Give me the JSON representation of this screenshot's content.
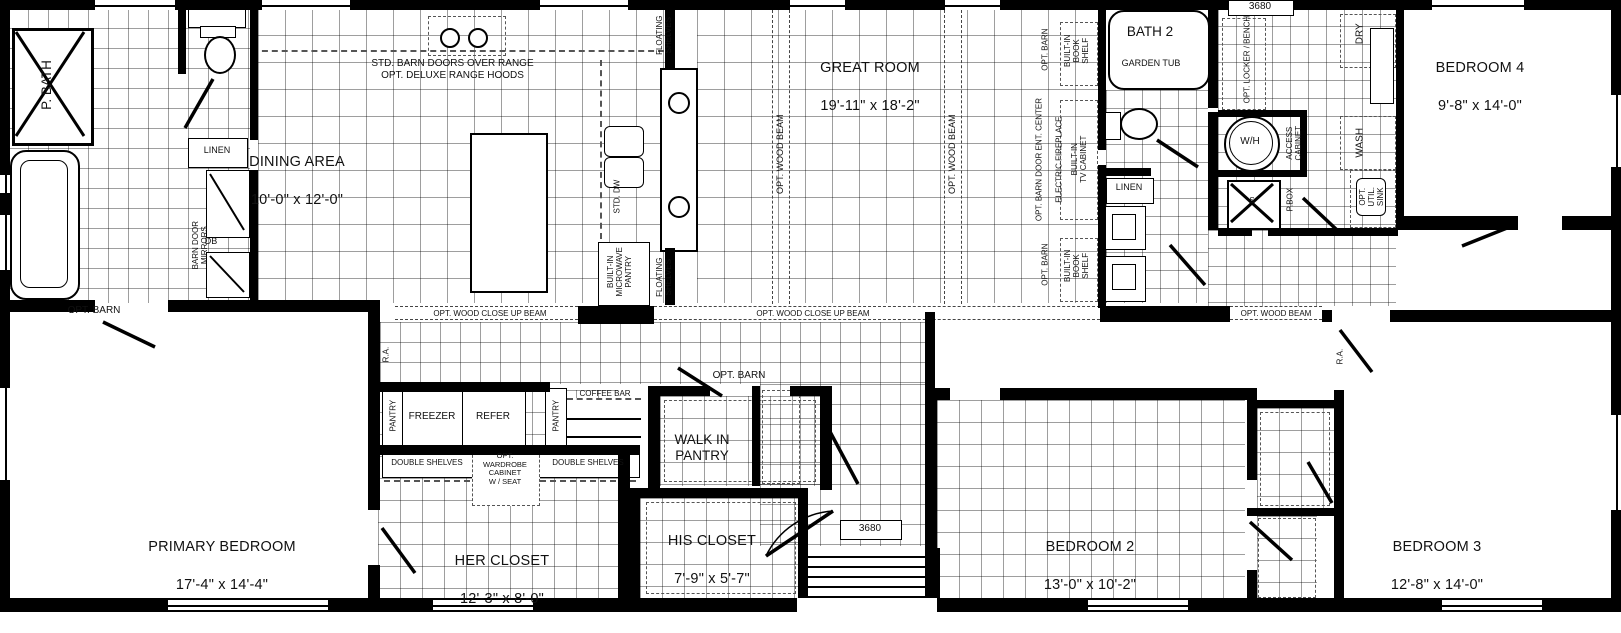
{
  "rooms": {
    "p_bath": {
      "name": "P. BATH"
    },
    "dining": {
      "name": "DINING AREA",
      "dims": "10'-0\" x 12'-0\""
    },
    "great_room": {
      "name": "GREAT ROOM",
      "dims": "19'-11\" x 18'-2\""
    },
    "bath2": {
      "name": "BATH 2",
      "sub": "GARDEN TUB"
    },
    "bedroom4": {
      "name": "BEDROOM 4",
      "dims": "9'-8\" x 14'-0\""
    },
    "primary": {
      "name": "PRIMARY BEDROOM",
      "dims": "17'-4\" x 14'-4\""
    },
    "her_closet": {
      "name": "HER CLOSET",
      "dims": "12'-3\" x 8'-0\""
    },
    "his_closet": {
      "name": "HIS CLOSET",
      "dims": "7'-9\" x 5'-7\""
    },
    "walk_in_pantry": {
      "name": "WALK IN\nPANTRY"
    },
    "bedroom2": {
      "name": "BEDROOM 2",
      "dims": "13'-0\" x 10'-2\""
    },
    "bedroom3": {
      "name": "BEDROOM 3",
      "dims": "12'-8\" x 14'-0\""
    }
  },
  "labels": {
    "linen": "LINEN",
    "barn_door_mirrors": "BARN DOOR\nMIRRORS",
    "db": "DB",
    "range_note": "STD. BARN DOORS OVER RANGE\nOPT. DELUXE RANGE HOODS",
    "floating_shelves": "FLOATING\nSHELVES",
    "std_dw": "STD. DW",
    "built_in_microwave_pantry": "BUILT-IN\nMICROWAVE\nPANTRY",
    "opt_wood_beam": "OPT. WOOD BEAM",
    "opt_wood_close_up_beam": "OPT. WOOD CLOSE UP BEAM",
    "opt_barn": "OPT. BARN",
    "built_in_book_shelf": "BUILT-IN\nBOOK\nSHELF",
    "opt_barn_door_ent_center": "OPT. BARN DOOR ENT. CENTER",
    "electric_fireplace": "ELECTRIC FIREPLACE",
    "built_in_tv_cabinet": "BUILT-IN\nTV CABINET",
    "door_3680": "3680",
    "opt_locker_bench": "OPT. LOCKER / BENCH",
    "dry": "DRY",
    "wash": "WASH",
    "wh": "W/H",
    "s": "S",
    "access_cabinet": "ACCESS\nCABINET",
    "p_box": "P.BOX",
    "opt_util_sink": "OPT.\nUTIL.\nSINK",
    "ra": "R.A.",
    "pantry": "PANTRY",
    "freezer": "FREEZER",
    "refer": "REFER",
    "coffee_bar": "COFFEE BAR",
    "double_shelves": "DOUBLE SHELVES",
    "opt_wardrobe": "OPT.\nWARDROBE\nCABINET\nW / SEAT"
  }
}
